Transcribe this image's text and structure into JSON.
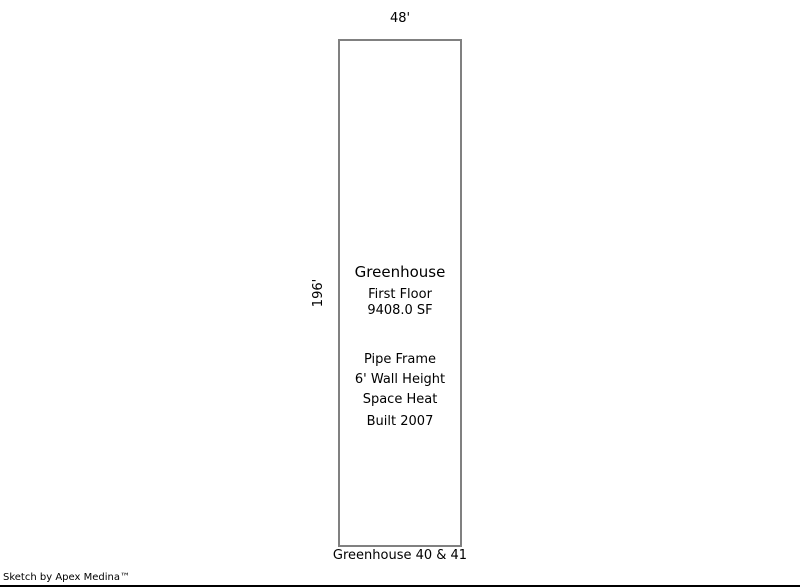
{
  "sketch": {
    "dimensions": {
      "width_label": "48'",
      "height_label": "196'"
    },
    "area": {
      "title": "Greenhouse",
      "floor": "First Floor",
      "square_feet": "9408.0 SF",
      "frame": "Pipe Frame",
      "wall_height": "6' Wall Height",
      "heating": "Space Heat",
      "built": "Built 2007"
    },
    "caption": "Greenhouse 40 & 41",
    "credit": "Sketch by Apex Medina™",
    "colors": {
      "outline": "#808080",
      "text": "#000000",
      "background": "#ffffff",
      "bottom_rule": "#000000"
    }
  }
}
